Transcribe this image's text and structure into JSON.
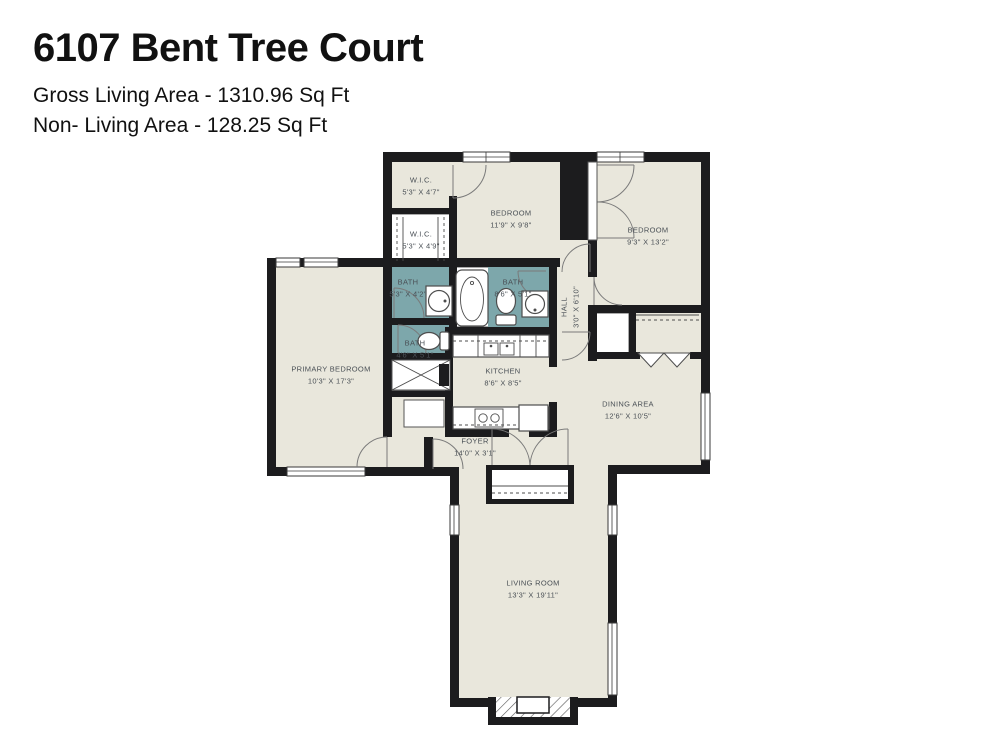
{
  "header": {
    "title": "6107 Bent Tree Court",
    "gross_area_line": "Gross Living Area - 1310.96 Sq Ft",
    "non_living_area_line": "Non- Living Area - 128.25 Sq Ft"
  },
  "colors": {
    "room_fill": "#e9e7dc",
    "bath_fill": "#7da7ab",
    "wall": "#1c1c1e",
    "label_text": "#4a5056"
  },
  "rooms": [
    {
      "id": "wic1",
      "name": "W.I.C.",
      "dims": "5'3\" X 4'7\""
    },
    {
      "id": "wic2",
      "name": "W.I.C.",
      "dims": "5'3\" X 4'9\""
    },
    {
      "id": "bedroom1",
      "name": "BEDROOM",
      "dims": "11'9\" X 9'8\""
    },
    {
      "id": "bedroom2",
      "name": "BEDROOM",
      "dims": "9'3\" X 13'2\""
    },
    {
      "id": "bath1",
      "name": "BATH",
      "dims": "5'3\" X 4'2\""
    },
    {
      "id": "bath2",
      "name": "BATH",
      "dims": "8'6\" X 5'1\""
    },
    {
      "id": "hall",
      "name": "HALL",
      "dims": "3'0\" X 6'10\"",
      "vertical": true
    },
    {
      "id": "bath3",
      "name": "BATH",
      "dims": "4'6\" X 5'1\""
    },
    {
      "id": "primary",
      "name": "PRIMARY BEDROOM",
      "dims": "10'3\" X 17'3\""
    },
    {
      "id": "kitchen",
      "name": "KITCHEN",
      "dims": "8'6\" X 8'5\""
    },
    {
      "id": "dining",
      "name": "DINING AREA",
      "dims": "12'6\" X 10'5\""
    },
    {
      "id": "foyer",
      "name": "FOYER",
      "dims": "14'0\" X 3'1\""
    },
    {
      "id": "living",
      "name": "LIVING ROOM",
      "dims": "13'3\" X 19'11\""
    }
  ]
}
